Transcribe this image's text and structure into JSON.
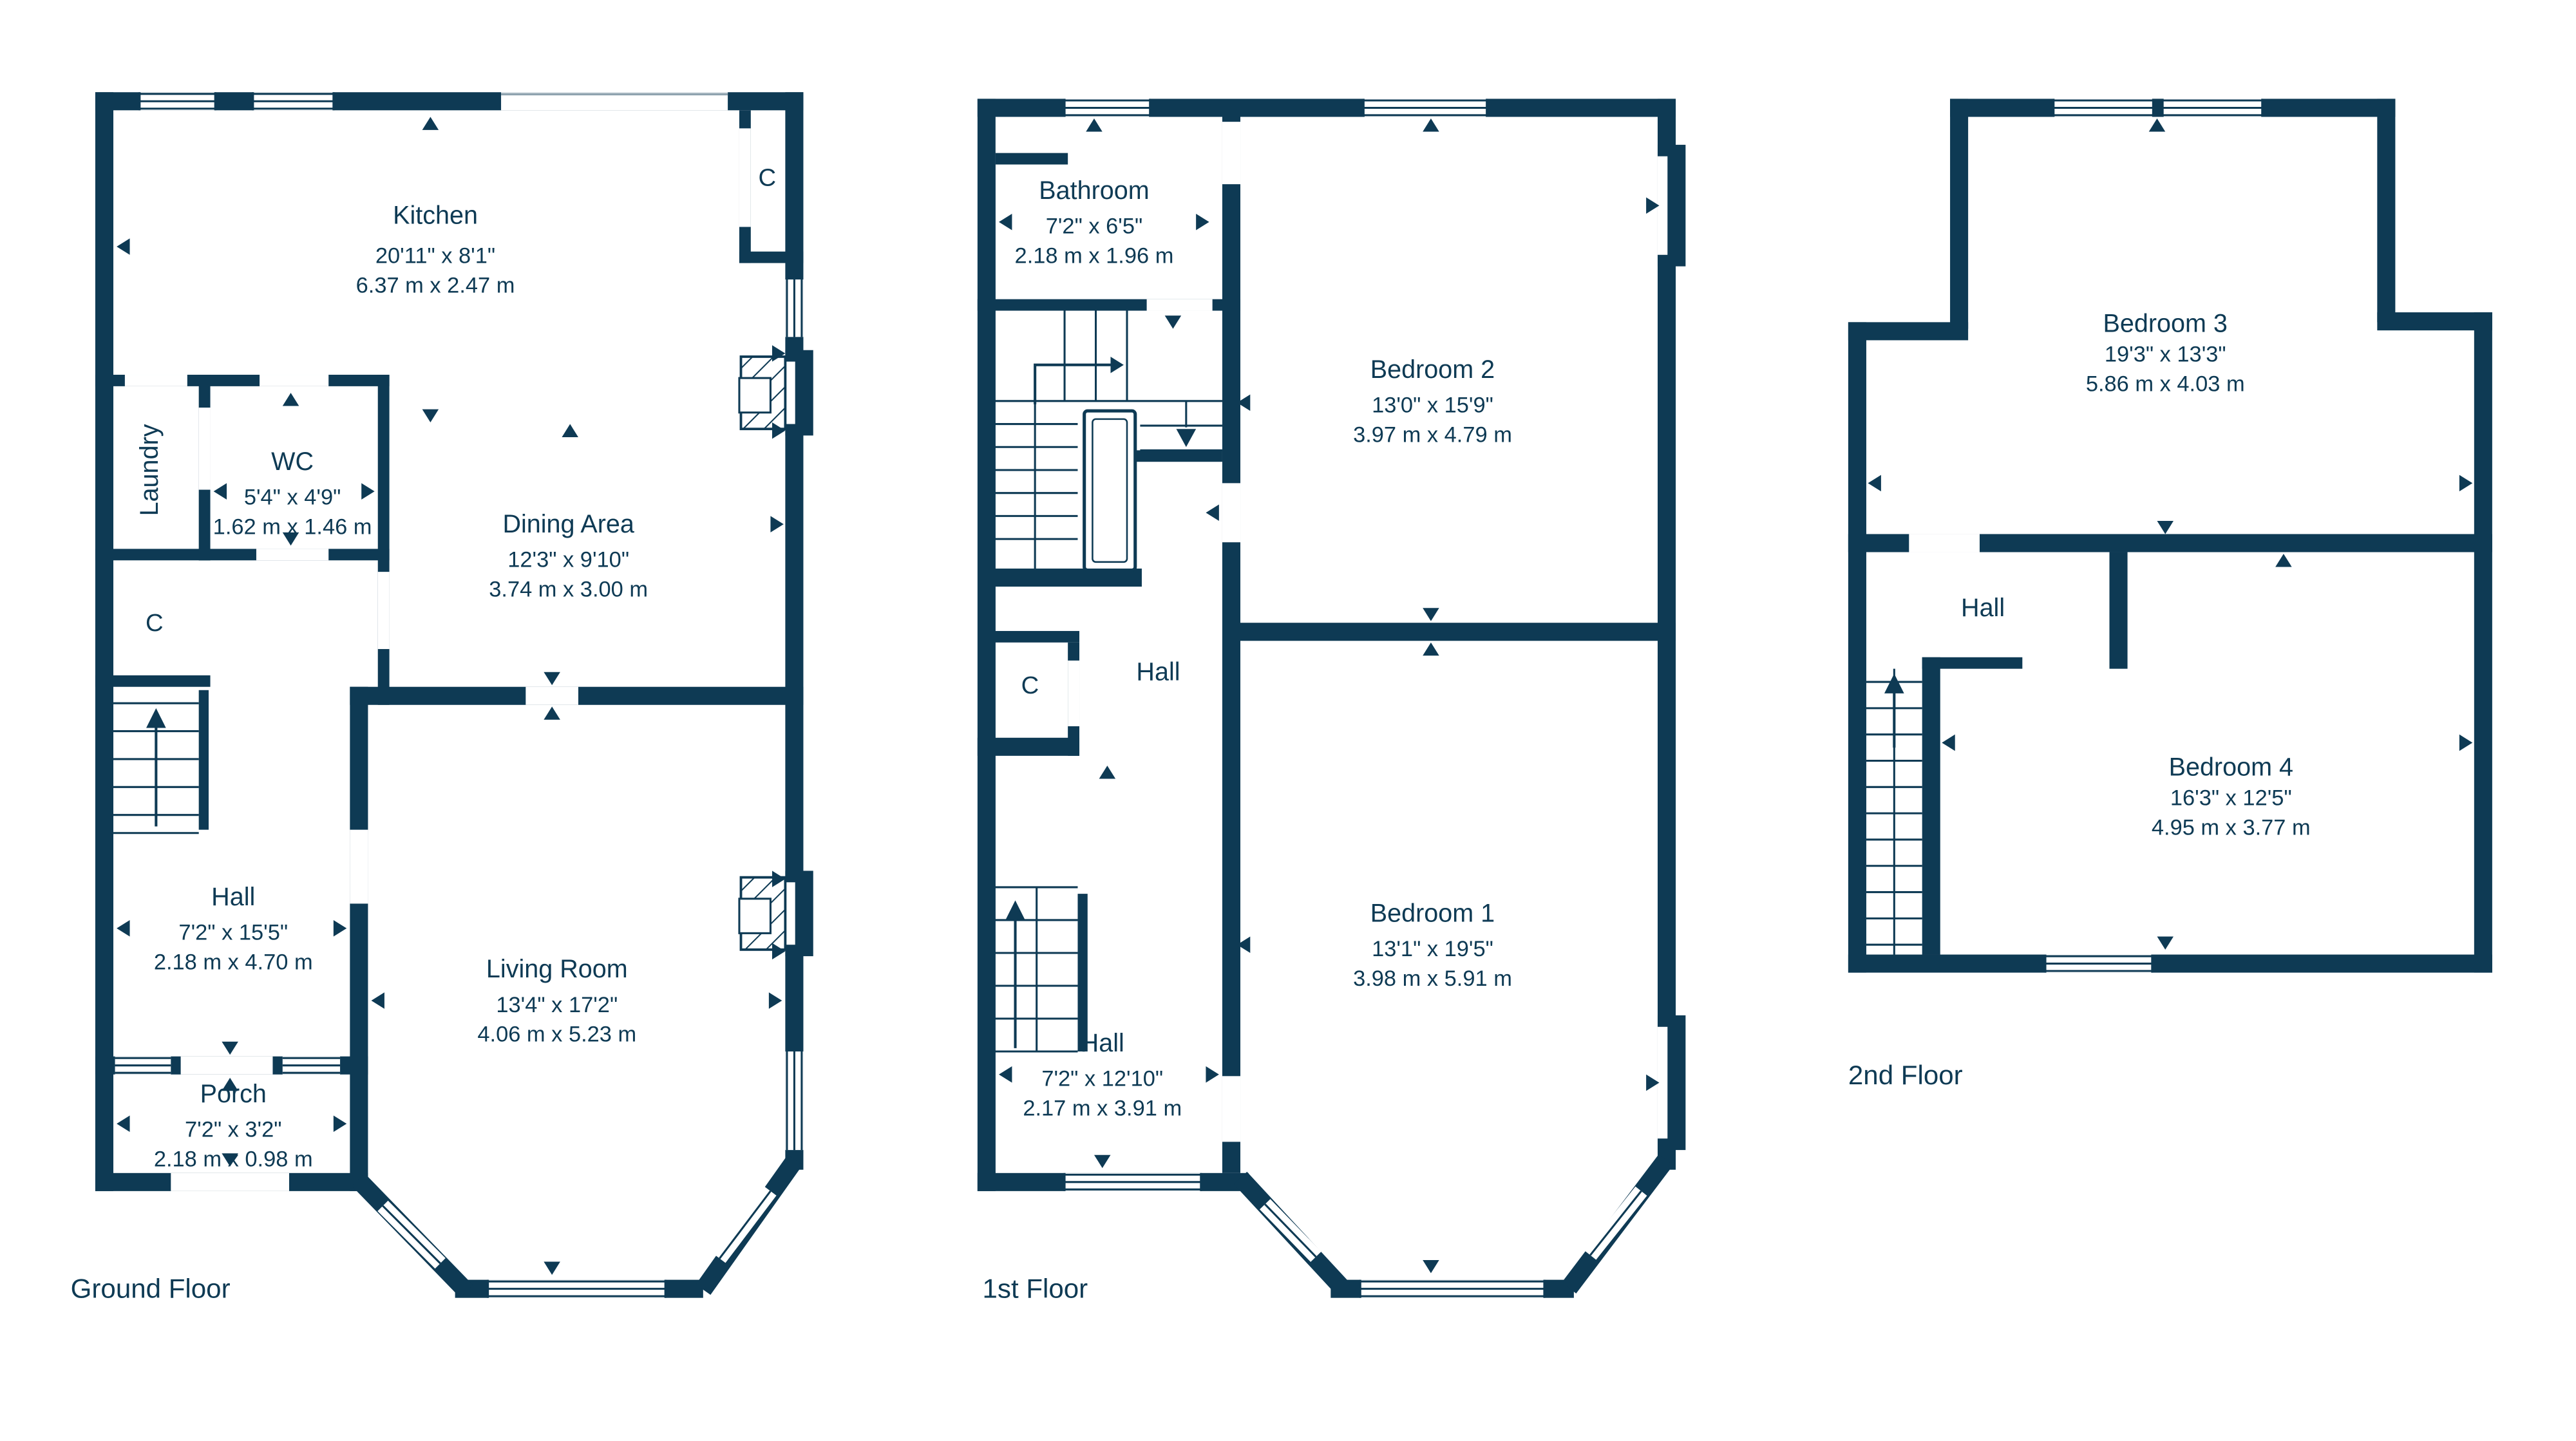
{
  "colors": {
    "wall": "#0e3a54",
    "text": "#0e3a54"
  },
  "floors": [
    {
      "label": "Ground Floor",
      "rooms": {
        "kitchen": {
          "name": "Kitchen",
          "imperial": "20'11\" x 8'1\"",
          "metric": "6.37 m x 2.47 m"
        },
        "wc": {
          "name": "WC",
          "imperial": "5'4\" x 4'9\"",
          "metric": "1.62 m x 1.46 m"
        },
        "laundry": {
          "name": "Laundry"
        },
        "closet_top": {
          "name": "C"
        },
        "closet_left": {
          "name": "C"
        },
        "dining": {
          "name": "Dining Area",
          "imperial": "12'3\" x 9'10\"",
          "metric": "3.74 m x 3.00 m"
        },
        "hall": {
          "name": "Hall",
          "imperial": "7'2\" x 15'5\"",
          "metric": "2.18 m x 4.70 m"
        },
        "porch": {
          "name": "Porch",
          "imperial": "7'2\" x 3'2\"",
          "metric": "2.18 m x 0.98 m"
        },
        "living": {
          "name": "Living Room",
          "imperial": "13'4\" x 17'2\"",
          "metric": "4.06 m x 5.23 m"
        }
      }
    },
    {
      "label": "1st Floor",
      "rooms": {
        "bathroom": {
          "name": "Bathroom",
          "imperial": "7'2\" x 6'5\"",
          "metric": "2.18 m x 1.96 m"
        },
        "bedroom2": {
          "name": "Bedroom 2",
          "imperial": "13'0\" x 15'9\"",
          "metric": "3.97 m x 4.79 m"
        },
        "hall_upper": {
          "name": "Hall"
        },
        "closet": {
          "name": "C"
        },
        "bedroom1": {
          "name": "Bedroom 1",
          "imperial": "13'1\" x 19'5\"",
          "metric": "3.98 m x 5.91 m"
        },
        "hall_lower": {
          "name": "Hall",
          "imperial": "7'2\" x 12'10\"",
          "metric": "2.17 m x 3.91 m"
        }
      }
    },
    {
      "label": "2nd Floor",
      "rooms": {
        "bedroom3": {
          "name": "Bedroom 3",
          "imperial": "19'3\" x 13'3\"",
          "metric": "5.86 m x 4.03 m"
        },
        "hall": {
          "name": "Hall"
        },
        "bedroom4": {
          "name": "Bedroom 4",
          "imperial": "16'3\" x 12'5\"",
          "metric": "4.95 m x 3.77 m"
        }
      }
    }
  ]
}
